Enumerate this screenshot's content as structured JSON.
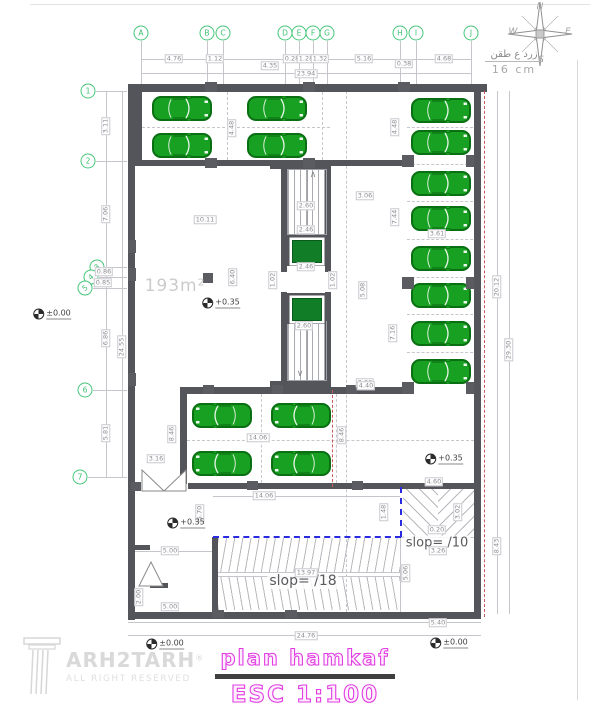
{
  "texts": {
    "area_label": "193m²",
    "slope10": "slop= /10",
    "slope18": "slop= /18",
    "note_line1": "زرد ع طقن",
    "note_line2": "16 cm",
    "title": "plan hamkaf",
    "scale": "ESC 1:100",
    "brand": "ARH2TARH",
    "brand_reg": "®",
    "tagline": "ALL RIGHT RESERVED"
  },
  "compass": {
    "n": "N",
    "e": "E",
    "s": "S",
    "w": "W"
  },
  "grid_columns": [
    {
      "label": "A",
      "x": 141
    },
    {
      "label": "B",
      "x": 207
    },
    {
      "label": "C",
      "x": 223
    },
    {
      "label": "D",
      "x": 285
    },
    {
      "label": "E",
      "x": 299
    },
    {
      "label": "F",
      "x": 313
    },
    {
      "label": "G",
      "x": 327
    },
    {
      "label": "H",
      "x": 400
    },
    {
      "label": "I",
      "x": 416
    },
    {
      "label": "J",
      "x": 471
    }
  ],
  "grid_rows": [
    {
      "label": "1",
      "y": 91,
      "bx": 88
    },
    {
      "label": "2",
      "y": 161,
      "bx": 88
    },
    {
      "label": "3",
      "y": 267,
      "bx": 97,
      "tilt": true
    },
    {
      "label": "4",
      "y": 277,
      "bx": 91,
      "tilt": true
    },
    {
      "label": "5",
      "y": 288,
      "bx": 85,
      "tilt": true
    },
    {
      "label": "6",
      "y": 390,
      "bx": 85
    },
    {
      "label": "7",
      "y": 477,
      "bx": 80
    }
  ],
  "levels": [
    {
      "t": "±0.00",
      "x": 52,
      "y": 314
    },
    {
      "t": "+0.35",
      "x": 221,
      "y": 303
    },
    {
      "t": "+0.35",
      "x": 444,
      "y": 459
    },
    {
      "t": "+0.35",
      "x": 186,
      "y": 523
    },
    {
      "t": "±0.00",
      "x": 165,
      "y": 644
    },
    {
      "t": "±0.00",
      "x": 449,
      "y": 643
    }
  ],
  "marks": [
    {
      "t": "∧",
      "x": 313,
      "y": 175
    },
    {
      "t": "∨",
      "x": 300,
      "y": 374
    }
  ],
  "dims": [
    {
      "t": "4.76",
      "x": 174,
      "y": 59
    },
    {
      "t": "1.12",
      "x": 215,
      "y": 59
    },
    {
      "t": "4.35",
      "x": 270,
      "y": 66
    },
    {
      "t": "0.28",
      "x": 292,
      "y": 59
    },
    {
      "t": "1.28",
      "x": 306,
      "y": 59
    },
    {
      "t": "1.32",
      "x": 320,
      "y": 59
    },
    {
      "t": "5.16",
      "x": 364,
      "y": 59
    },
    {
      "t": "0.38",
      "x": 404,
      "y": 64
    },
    {
      "t": "4.68",
      "x": 444,
      "y": 59
    },
    {
      "t": "23.94",
      "x": 306,
      "y": 74
    },
    {
      "t": "3.11",
      "x": 106,
      "y": 126,
      "r": true
    },
    {
      "t": "7.06",
      "x": 106,
      "y": 214,
      "r": true
    },
    {
      "t": "0.86",
      "x": 104,
      "y": 272
    },
    {
      "t": "0.85",
      "x": 103,
      "y": 283
    },
    {
      "t": "6.86",
      "x": 106,
      "y": 338,
      "r": true
    },
    {
      "t": "5.81",
      "x": 106,
      "y": 433,
      "r": true
    },
    {
      "t": "24.55",
      "x": 122,
      "y": 347,
      "r": true
    },
    {
      "t": "20.12",
      "x": 497,
      "y": 287,
      "r": true
    },
    {
      "t": "29.30",
      "x": 509,
      "y": 350,
      "r": true
    },
    {
      "t": "8.43",
      "x": 497,
      "y": 546,
      "r": true
    },
    {
      "t": "4.48",
      "x": 232,
      "y": 128,
      "r": true
    },
    {
      "t": "4.48",
      "x": 395,
      "y": 127,
      "r": true
    },
    {
      "t": "7.44",
      "x": 395,
      "y": 217,
      "r": true
    },
    {
      "t": "7.16",
      "x": 393,
      "y": 333,
      "r": true
    },
    {
      "t": "3.61",
      "x": 437,
      "y": 234
    },
    {
      "t": "10.11",
      "x": 205,
      "y": 220
    },
    {
      "t": "6.40",
      "x": 233,
      "y": 277,
      "r": true
    },
    {
      "t": "2.60",
      "x": 306,
      "y": 206
    },
    {
      "t": "2.46",
      "x": 306,
      "y": 230
    },
    {
      "t": "2.46",
      "x": 306,
      "y": 267
    },
    {
      "t": "2.60",
      "x": 304,
      "y": 326
    },
    {
      "t": "1.02",
      "x": 273,
      "y": 280,
      "r": true
    },
    {
      "t": "1.02",
      "x": 333,
      "y": 280,
      "r": true
    },
    {
      "t": "3.06",
      "x": 365,
      "y": 196
    },
    {
      "t": "5.08",
      "x": 363,
      "y": 290,
      "r": true
    },
    {
      "t": "3.06",
      "x": 365,
      "y": 383
    },
    {
      "t": "14.06",
      "x": 258,
      "y": 438
    },
    {
      "t": "3.16",
      "x": 156,
      "y": 459
    },
    {
      "t": "8.46",
      "x": 172,
      "y": 434,
      "r": true
    },
    {
      "t": "8.46",
      "x": 342,
      "y": 435,
      "r": true
    },
    {
      "t": "4.40",
      "x": 366,
      "y": 386
    },
    {
      "t": "4.60",
      "x": 434,
      "y": 482
    },
    {
      "t": "14.06",
      "x": 264,
      "y": 496
    },
    {
      "t": "5.70",
      "x": 200,
      "y": 513,
      "r": true
    },
    {
      "t": "1.48",
      "x": 384,
      "y": 512,
      "r": true
    },
    {
      "t": "3.02",
      "x": 458,
      "y": 512,
      "r": true
    },
    {
      "t": "0.20",
      "x": 437,
      "y": 530
    },
    {
      "t": "3.26",
      "x": 438,
      "y": 551
    },
    {
      "t": "5.06",
      "x": 406,
      "y": 573,
      "r": true
    },
    {
      "t": "13.97",
      "x": 306,
      "y": 573
    },
    {
      "t": "5.00",
      "x": 170,
      "y": 551
    },
    {
      "t": "2.00",
      "x": 139,
      "y": 597,
      "r": true
    },
    {
      "t": "5.00",
      "x": 170,
      "y": 607
    },
    {
      "t": "5.40",
      "x": 438,
      "y": 623
    },
    {
      "t": "24.76",
      "x": 306,
      "y": 636
    }
  ],
  "cars": {
    "color": "#18a022",
    "stalls": [
      {
        "x": 152,
        "y": 96,
        "dir": "right"
      },
      {
        "x": 152,
        "y": 133,
        "dir": "right"
      },
      {
        "x": 247,
        "y": 96,
        "dir": "right"
      },
      {
        "x": 247,
        "y": 133,
        "dir": "right"
      },
      {
        "x": 411,
        "y": 98,
        "dir": "right"
      },
      {
        "x": 411,
        "y": 130,
        "dir": "right"
      },
      {
        "x": 411,
        "y": 171,
        "dir": "right"
      },
      {
        "x": 411,
        "y": 206,
        "dir": "right"
      },
      {
        "x": 411,
        "y": 246,
        "dir": "right"
      },
      {
        "x": 411,
        "y": 283,
        "dir": "right"
      },
      {
        "x": 411,
        "y": 321,
        "dir": "right"
      },
      {
        "x": 411,
        "y": 359,
        "dir": "right"
      },
      {
        "x": 192,
        "y": 403,
        "dir": "left"
      },
      {
        "x": 192,
        "y": 451,
        "dir": "left"
      },
      {
        "x": 271,
        "y": 403,
        "dir": "left"
      },
      {
        "x": 271,
        "y": 451,
        "dir": "left"
      }
    ]
  }
}
